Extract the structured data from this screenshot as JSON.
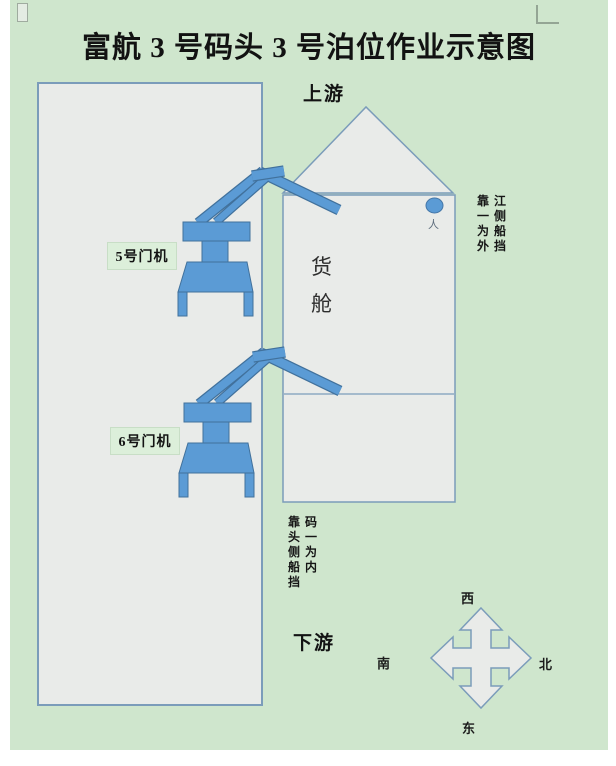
{
  "document": {
    "title": "富航 3 号码头 3 号泊位作业示意图"
  },
  "river": {
    "upstream_label": "上游",
    "downstream_label": "下游"
  },
  "cranes": [
    {
      "label": "5号门机"
    },
    {
      "label": "6号门机"
    }
  ],
  "ship": {
    "cargo_hold_char_top": "货",
    "cargo_hold_char_bottom": "舱",
    "person_label": "人"
  },
  "notes": {
    "river_side": [
      "靠江",
      "一侧",
      "为船",
      "外挡"
    ],
    "dock_side": [
      "靠码",
      "头一",
      "侧为",
      "船内",
      "挡"
    ]
  },
  "compass": {
    "top": "西",
    "right": "北",
    "bottom": "东",
    "left": "南"
  },
  "colors": {
    "page_background": "#cfe6cd",
    "shape_fill": "#e9ebe9",
    "shape_outline": "#7b9cba",
    "crane_fill": "#5b9bd5",
    "crane_outline": "#41719c",
    "label_box_background": "#dcefda"
  }
}
